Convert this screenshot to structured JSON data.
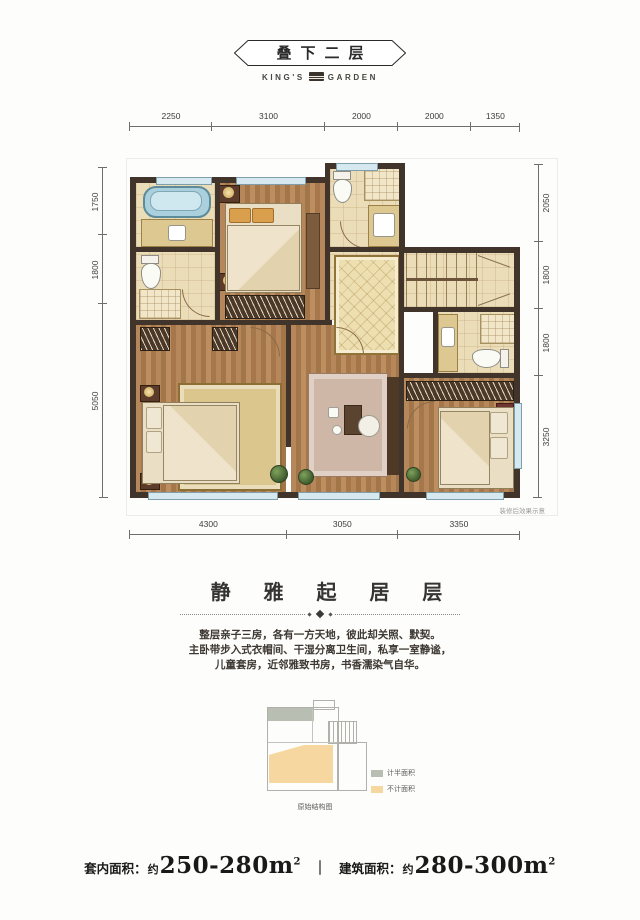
{
  "header": {
    "title": "叠下二层",
    "brand_left": "KING'S",
    "brand_right": "GARDEN"
  },
  "plan": {
    "note": "装修后效果示意",
    "dims": {
      "top": [
        "2250",
        "3100",
        "2000",
        "2000",
        "1350"
      ],
      "left": [
        "1750",
        "1800",
        "5050"
      ],
      "right": [
        "2050",
        "1800",
        "1800",
        "3250"
      ],
      "bottom": [
        "4300",
        "3050",
        "3350"
      ]
    },
    "colors": {
      "wall": "#41342a",
      "wood_floor": "#ad7e51",
      "tile_floor": "#ecddb9",
      "window": "#d6e9f0",
      "bathtub": "#a9d0dc"
    }
  },
  "section": {
    "title": "静 雅 起 居 层",
    "lines": [
      "整层亲子三房，各有一方天地，彼此却关照、默契。",
      "主卧带步入式衣帽间、干湿分离卫生间，私享一室静谧，",
      "儿童套房，近邻雅致书房，书香濡染气自华。"
    ]
  },
  "schematic": {
    "caption": "原始结构图",
    "legend": [
      {
        "label": "计半面积",
        "color": "#b9beb2"
      },
      {
        "label": "不计面积",
        "color": "#f5d79f"
      }
    ]
  },
  "footer": {
    "label_inner": "套内面积：",
    "approx_inner": "约",
    "value_inner": "250-280m",
    "sup_inner": "2",
    "divider": "｜",
    "label_build": "建筑面积：",
    "approx_build": "约",
    "value_build": "280-300m",
    "sup_build": "2"
  }
}
